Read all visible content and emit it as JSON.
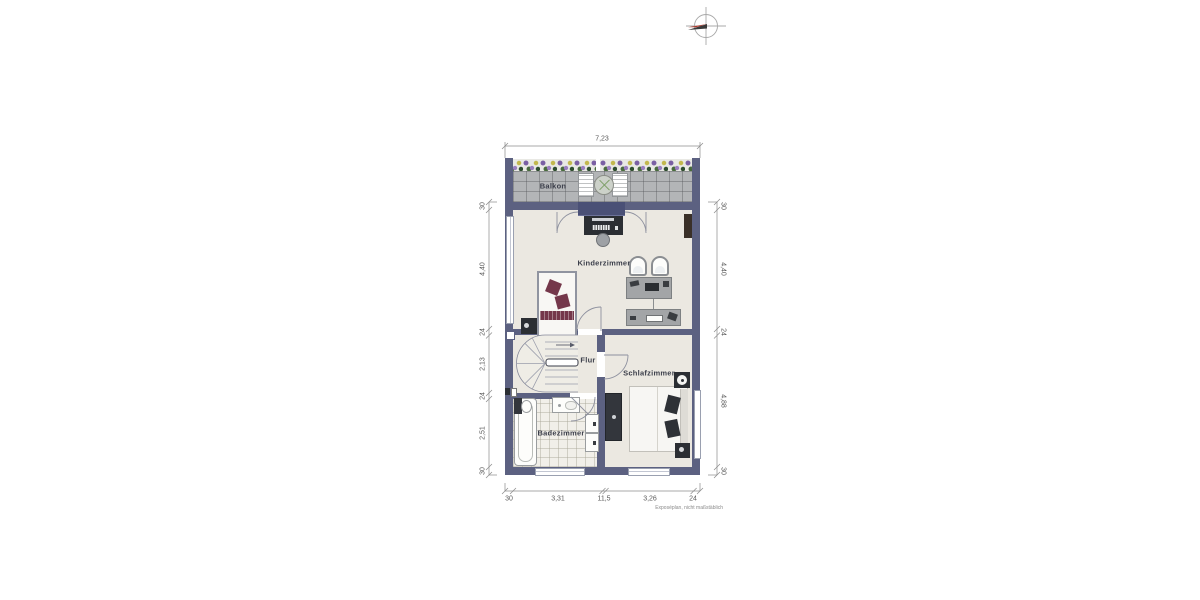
{
  "plan": {
    "type": "floorplan",
    "footnote": "Exposéplan, nicht maßstäblich",
    "rooms": [
      {
        "id": "balkon",
        "label": "Balkon"
      },
      {
        "id": "kinderzimmer",
        "label": "Kinderzimmer"
      },
      {
        "id": "flur",
        "label": "Flur"
      },
      {
        "id": "schlafzimmer",
        "label": "Schlafzimmer"
      },
      {
        "id": "badezimmer",
        "label": "Badezimmer"
      }
    ],
    "dimensions": {
      "top": [
        "7,23"
      ],
      "left": [
        "30",
        "4,40",
        "24",
        "2,13",
        "24",
        "2,51",
        "30"
      ],
      "right": [
        "30",
        "4,40",
        "24",
        "4,88",
        "30"
      ],
      "bottom": [
        "30",
        "3,31",
        "11,5",
        "3,26",
        "24"
      ]
    },
    "colors": {
      "wall": "#5c6181",
      "floor": "#ebe8e1",
      "balcony_tile": "#b3b5b7",
      "accent_maroon": "#74374a",
      "furniture_dark": "#2b2e33",
      "furniture_gray": "#a3a5a7",
      "dimension_text": "#5a5a5a"
    },
    "icons": [
      "compass-icon",
      "stairs-icon",
      "bed-icon",
      "bathtub-icon"
    ]
  }
}
